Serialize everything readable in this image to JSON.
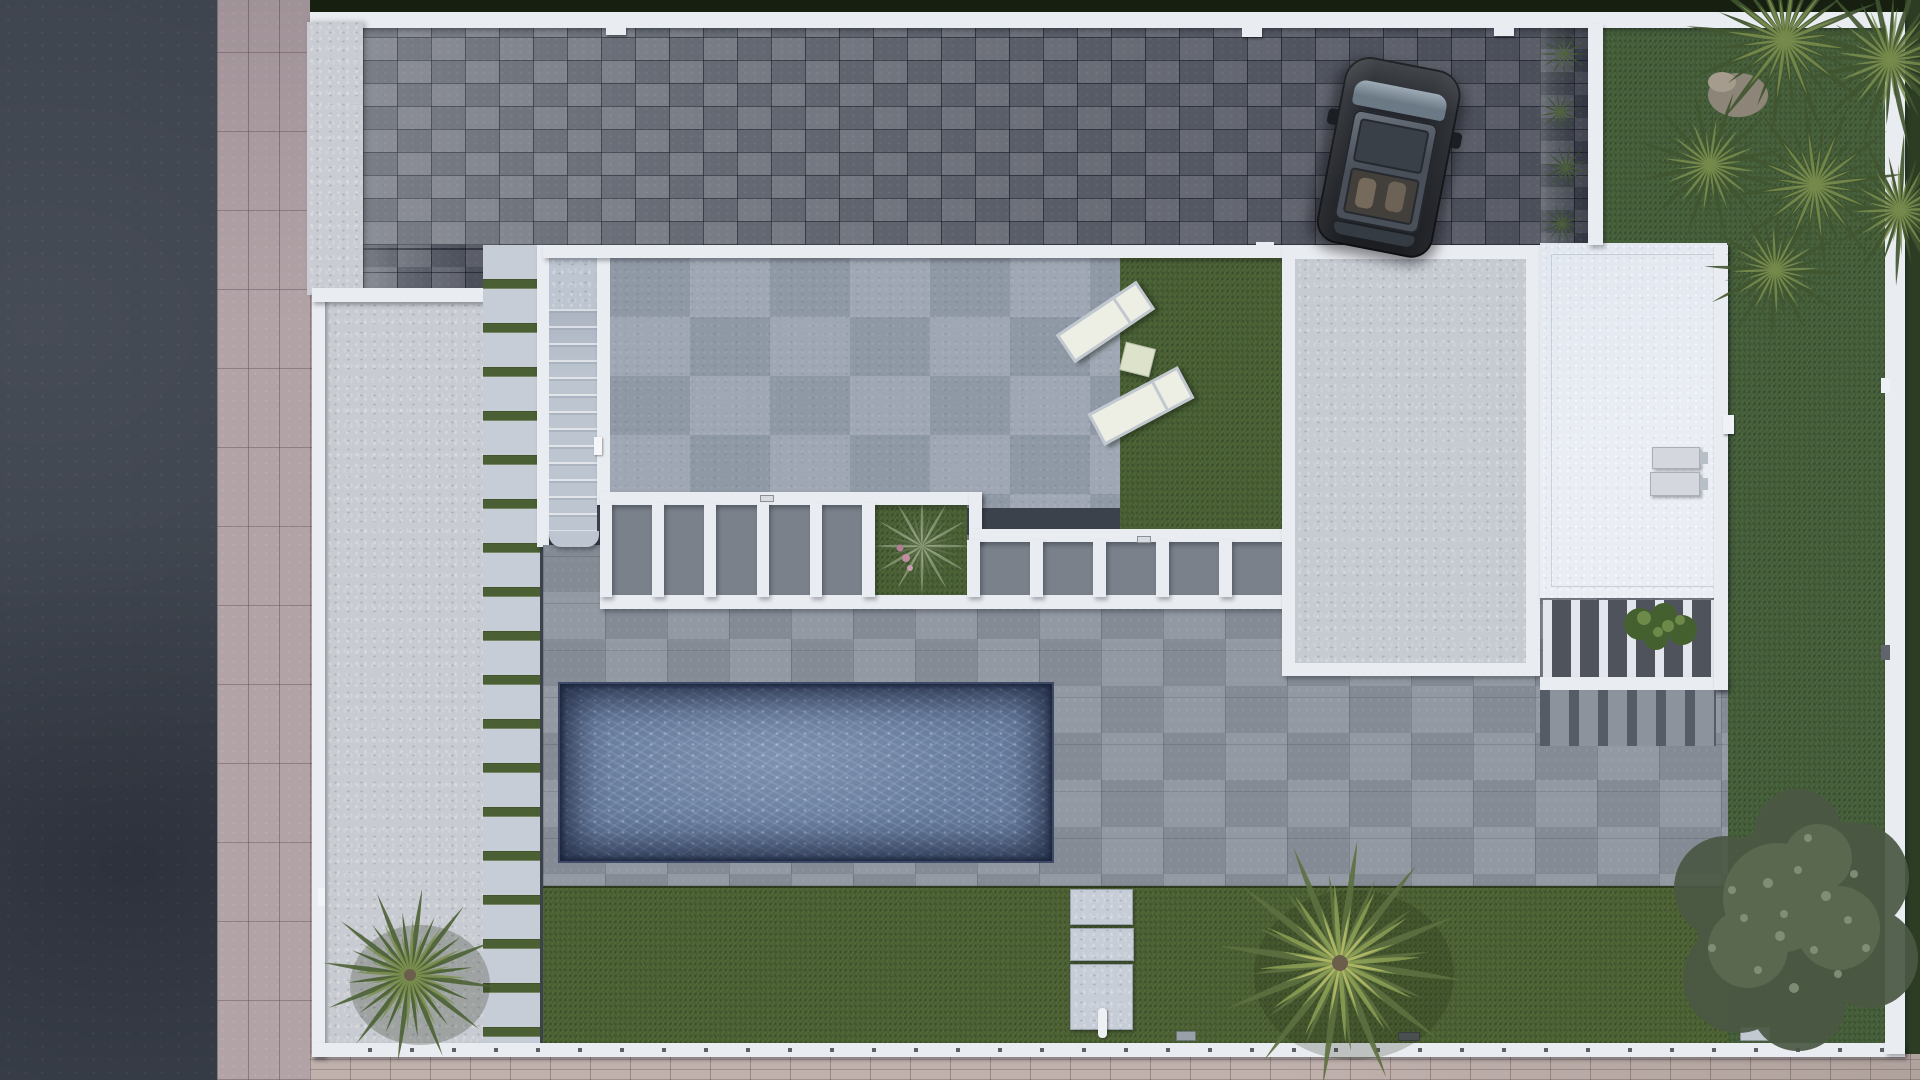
{
  "meta": {
    "title": "Aerial villa plot render",
    "description": "Top-down 3D architectural render of a modern villa plot: dark asphalt road and pink sidewalk on the left, block-paved driveway with a parked dark SUV at top, white-walled house with roof terrace, sun loungers, white beam pergola, gravel and white flat roofs with AC units, turquoise-gray swimming pool on a stone deck, lawns with palm trees and a large garden tree, all enclosed by white perimeter walls and hedges."
  },
  "palette": {
    "road": "#3c424c",
    "sidewalk": "#b2a3a7",
    "sidewalkBottom": "#c0b1ad",
    "hedge": "#161f10",
    "hedgeRight": "#2c3d24",
    "wallWhite": "#e9ecf1",
    "driveway": "#6a6f79",
    "shrubStrip": "#4a4f58",
    "entrancePillar": "#c9cdd3",
    "courtyard": "#c8ccd2",
    "ladderPad": "#c7cdd7",
    "grassJoint": "#4a5f33",
    "stairs": "#bdc5d1",
    "terrace": "#98a1ae",
    "turf": "#4a6134",
    "deck": "#8d939d",
    "deckOpening": "#7a818b",
    "gravelRoof": "#c6cbd2",
    "whiteRoof": "#eaeef4",
    "slatPatio": "#4f545c",
    "water": "#64799b",
    "lawnSouth": "#4d6334",
    "lawnEast": "#46603a",
    "carBody": "#25282e",
    "carGlass": "#495059",
    "carWindshield": "#64737f",
    "lounger": "#edefe4",
    "sideTable": "#dde3ca",
    "acUnit": "#d4d8de",
    "palmGreen": "#5d7040",
    "palmLight": "#8da055",
    "yuccaGreen": "#4f6436",
    "yuccaLight": "#7d9150",
    "treeFoliage": "#5c6a52",
    "treeLight": "#87957d",
    "agave": "#7e8f6e",
    "agaveFlower": "#c08ca0",
    "rock": "#8d8578"
  },
  "scene": {
    "surroundings": {
      "road_label": "asphalt road",
      "sidewalk_label": "pink tiled sidewalk",
      "hedge_label": "dark perimeter hedge"
    },
    "driveway": {
      "label": "block-paved driveway",
      "car_label": "parked SUV with panoramic glass roof",
      "gate_caps": 3,
      "planting_shrubs": 4
    },
    "house": {
      "terrace_label": "concrete roof terrace",
      "turf_label": "artificial turf patch",
      "loungers_count": 2,
      "side_table": 1,
      "stairs_label": "external staircase",
      "pergola_label": "white beam pergola",
      "pergola_bays_left": 5,
      "pergola_bays_right": 5,
      "pergola_planter_label": "agave planter opening",
      "gravel_roof_label": "gravel flat roof",
      "white_roof_label": "white flat roof",
      "ac_units": 2,
      "slatted_patio_label": "slatted patio with plants"
    },
    "garden": {
      "pool_label": "swimming pool",
      "deck_label": "stone pool deck",
      "lawn_label": "lawn",
      "stepping_pads": 3,
      "ladder_path_pads": 18,
      "palm_trees": 4,
      "yucca_heads": 6,
      "big_tree_label": "large garden tree",
      "courtyard_label": "side courtyard",
      "faucet_label": "garden faucet"
    },
    "walls": {
      "label": "white perimeter walls",
      "post_caps": "dark post caps along south wall"
    }
  }
}
